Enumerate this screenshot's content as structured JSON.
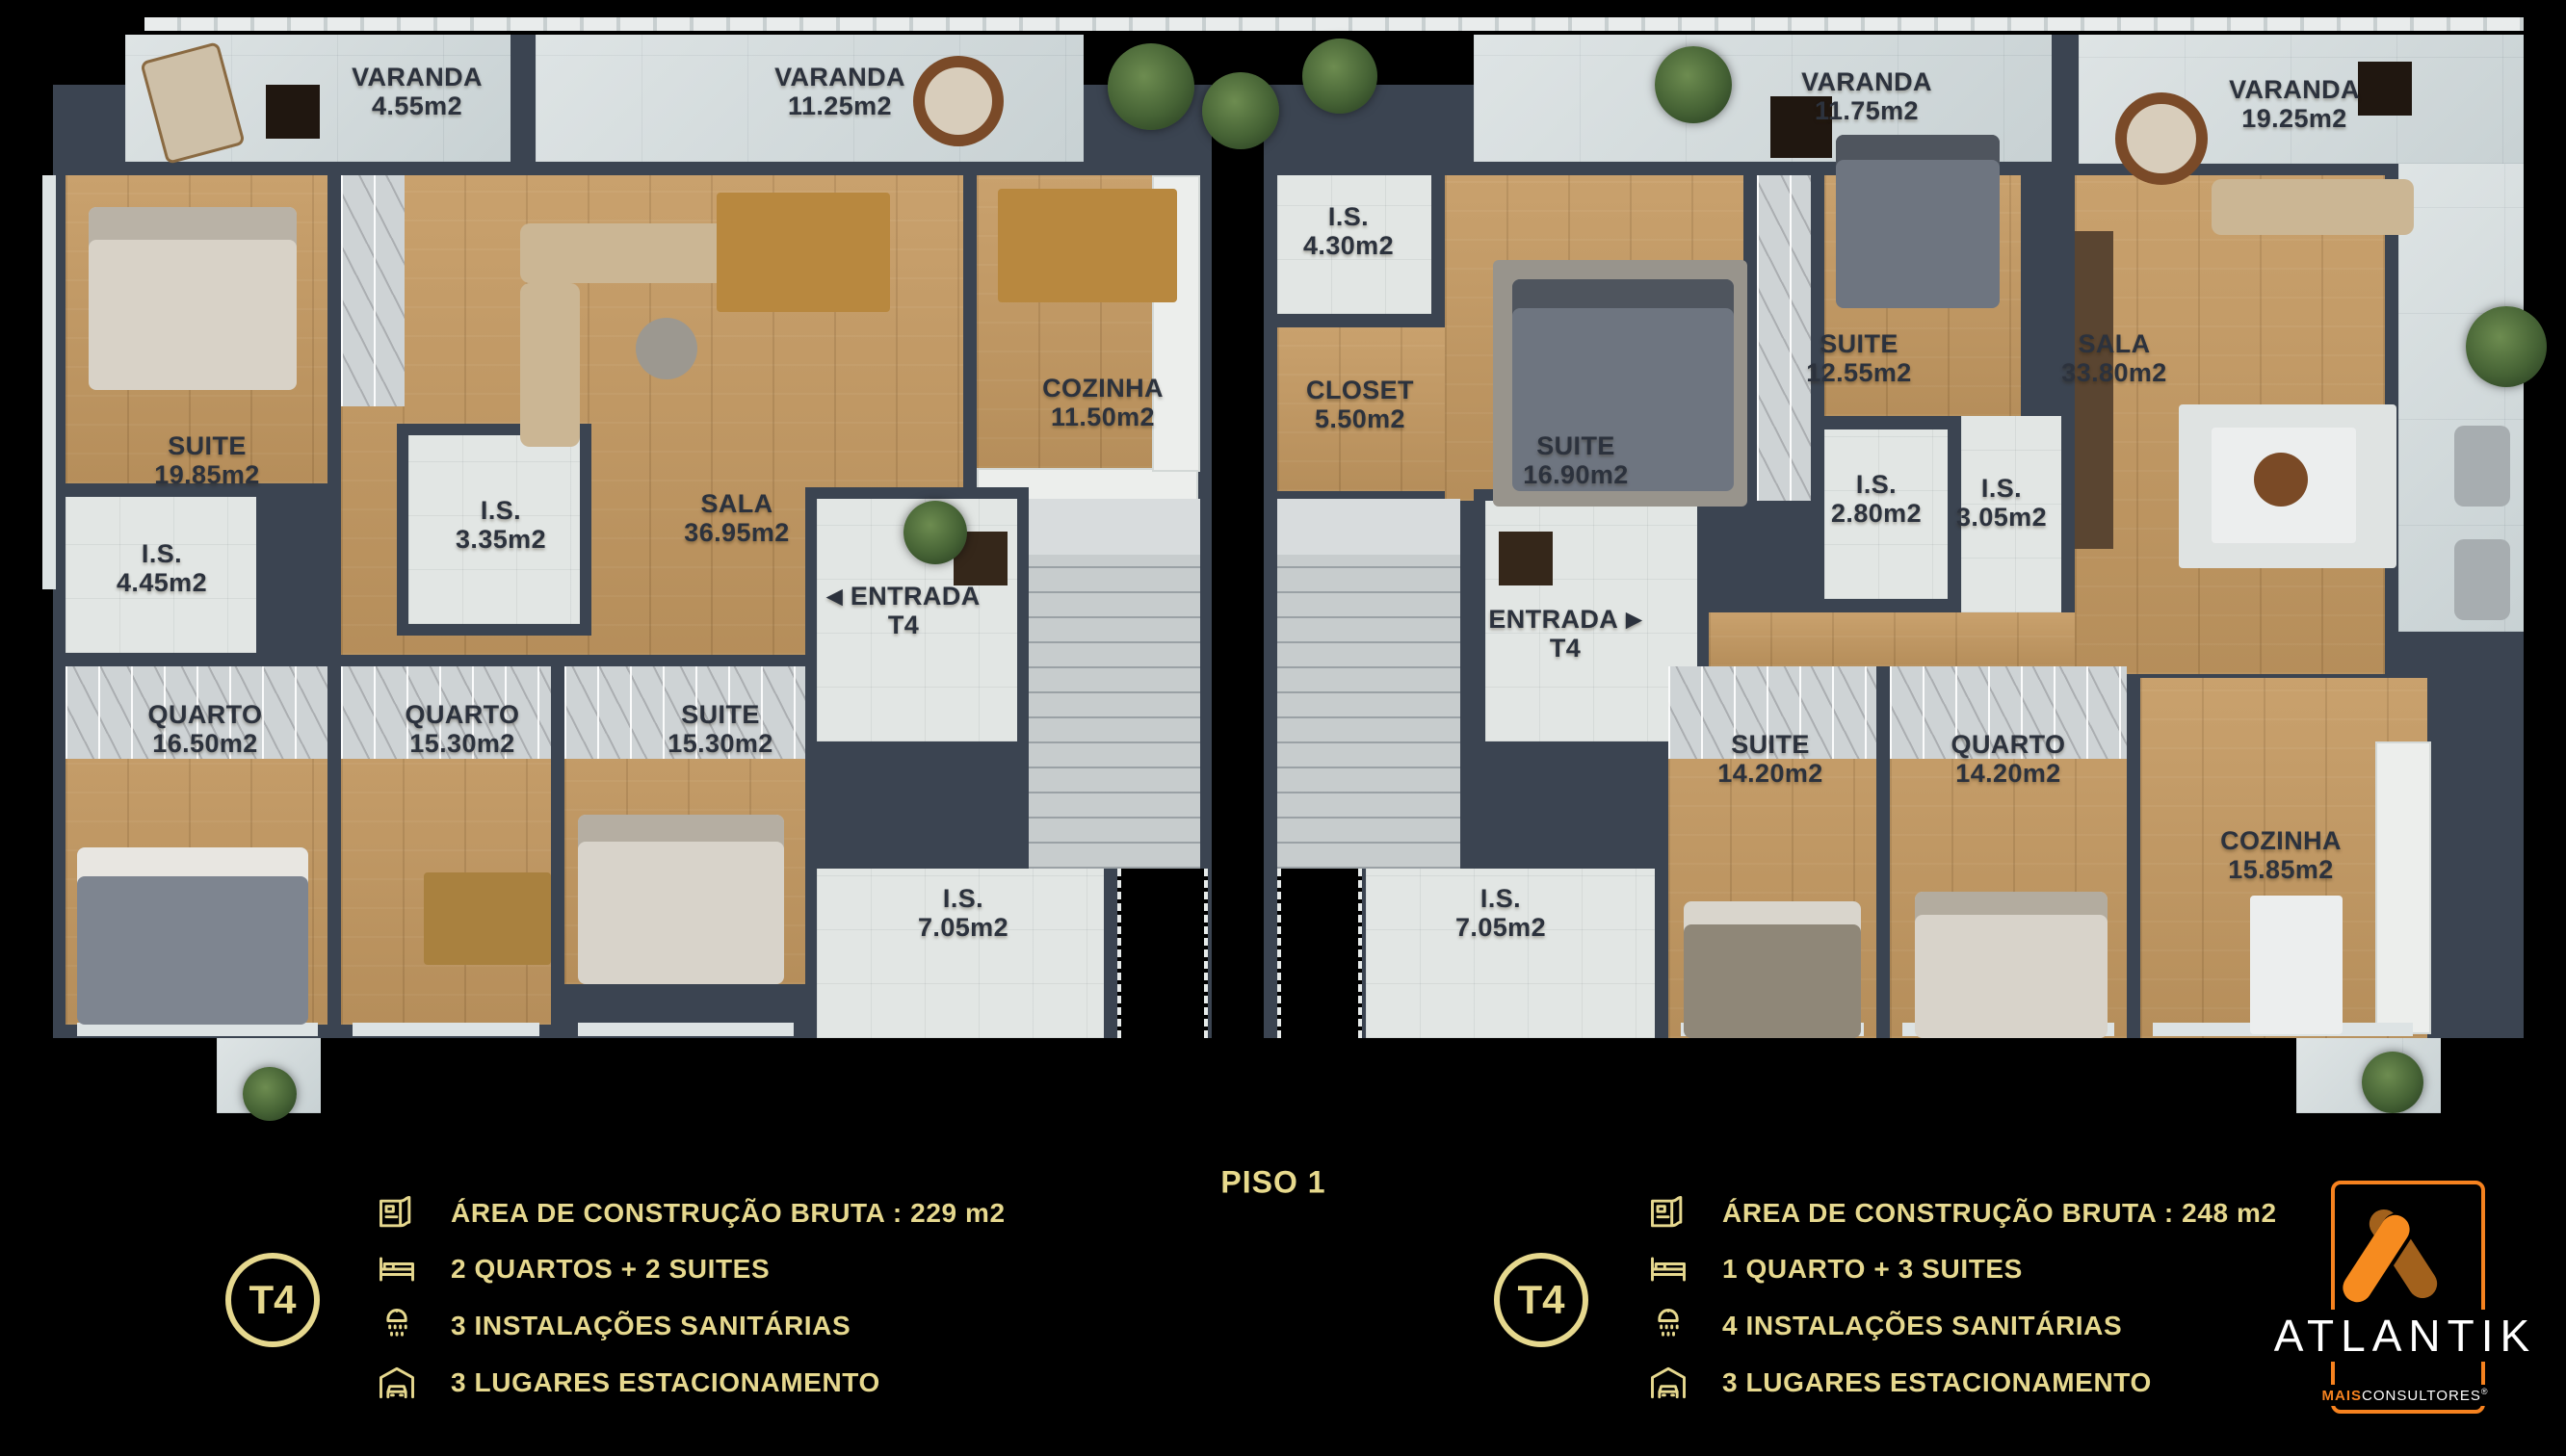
{
  "floor": {
    "label": "PISO 1"
  },
  "varandas": [
    {
      "name": "VARANDA",
      "area": "4.55m2"
    },
    {
      "name": "VARANDA",
      "area": "11.25m2"
    },
    {
      "name": "VARANDA",
      "area": "11.75m2"
    },
    {
      "name": "VARANDA",
      "area": "19.25m2"
    }
  ],
  "left_unit": {
    "entrance": {
      "arrow": "◀",
      "name": "ENTRADA",
      "unit": "T4"
    },
    "rooms": [
      {
        "name": "SUITE",
        "area": "19.85m2"
      },
      {
        "name": "I.S.",
        "area": "4.45m2"
      },
      {
        "name": "I.S.",
        "area": "3.35m2"
      },
      {
        "name": "SALA",
        "area": "36.95m2"
      },
      {
        "name": "COZINHA",
        "area": "11.50m2"
      },
      {
        "name": "QUARTO",
        "area": "16.50m2"
      },
      {
        "name": "QUARTO",
        "area": "15.30m2"
      },
      {
        "name": "SUITE",
        "area": "15.30m2"
      },
      {
        "name": "I.S.",
        "area": "7.05m2"
      }
    ]
  },
  "right_unit": {
    "entrance": {
      "name": "ENTRADA",
      "arrow": "▶",
      "unit": "T4"
    },
    "rooms": [
      {
        "name": "I.S.",
        "area": "4.30m2"
      },
      {
        "name": "CLOSET",
        "area": "5.50m2"
      },
      {
        "name": "SUITE",
        "area": "16.90m2"
      },
      {
        "name": "SUITE",
        "area": "12.55m2"
      },
      {
        "name": "I.S.",
        "area": "2.80m2"
      },
      {
        "name": "I.S.",
        "area": "3.05m2"
      },
      {
        "name": "SALA",
        "area": "33.80m2"
      },
      {
        "name": "SUITE",
        "area": "14.20m2"
      },
      {
        "name": "QUARTO",
        "area": "14.20m2"
      },
      {
        "name": "COZINHA",
        "area": "15.85m2"
      },
      {
        "name": "I.S.",
        "area": "7.05m2"
      }
    ]
  },
  "legend_left": {
    "badge": "T4",
    "items": [
      {
        "icon": "blueprint-icon",
        "text": "ÁREA DE CONSTRUÇÃO BRUTA :  229 m2"
      },
      {
        "icon": "bed-icon",
        "text": "2 QUARTOS + 2 SUITES"
      },
      {
        "icon": "shower-icon",
        "text": "3 INSTALAÇÕES SANITÁRIAS"
      },
      {
        "icon": "garage-icon",
        "text": "3 LUGARES ESTACIONAMENTO"
      }
    ]
  },
  "legend_right": {
    "badge": "T4",
    "items": [
      {
        "icon": "blueprint-icon",
        "text": "ÁREA DE CONSTRUÇÃO BRUTA :  248 m2"
      },
      {
        "icon": "bed-icon",
        "text": "1 QUARTO + 3 SUITES"
      },
      {
        "icon": "shower-icon",
        "text": "4 INSTALAÇÕES SANITÁRIAS"
      },
      {
        "icon": "garage-icon",
        "text": "3 LUGARES ESTACIONAMENTO"
      }
    ]
  },
  "logo": {
    "brand": "ATLANTIK",
    "sub_bold": "MAIS",
    "sub_rest": "CONSULTORES",
    "reg": "®"
  },
  "colors": {
    "gold": "#e6d88e",
    "orange": "#f6821f",
    "wall": "#3b4451",
    "wood": "#c59a62"
  }
}
